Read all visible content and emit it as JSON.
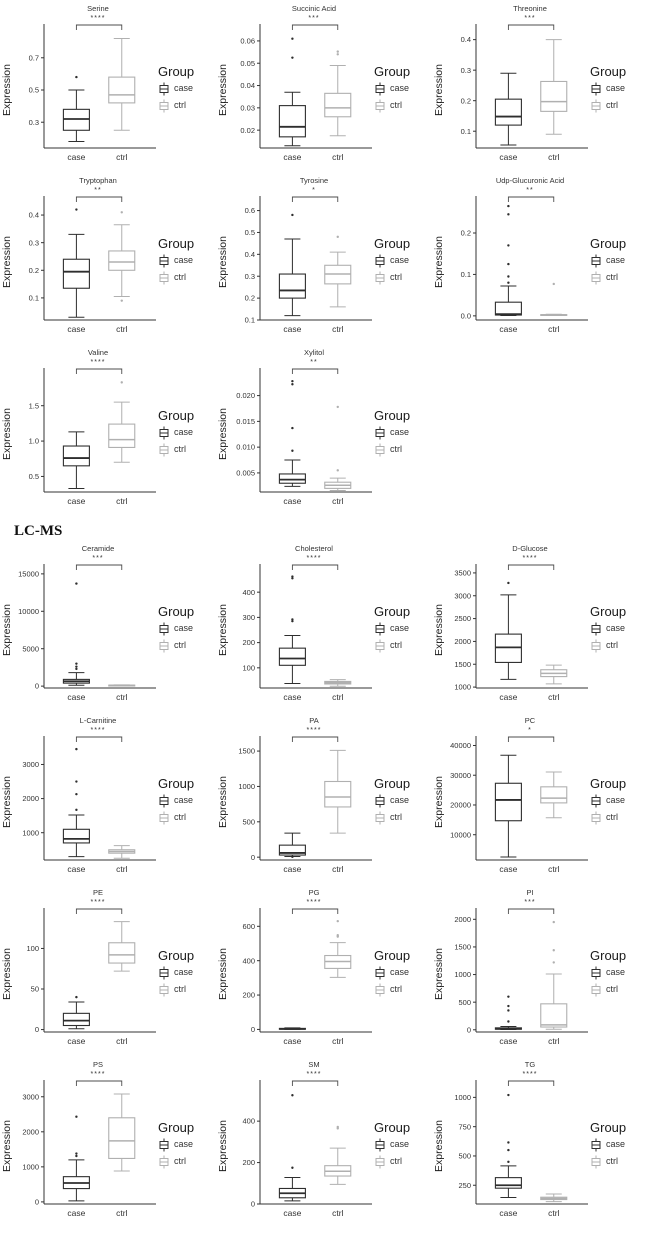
{
  "legend": {
    "title": "Group",
    "entries": [
      "case",
      "ctrl"
    ]
  },
  "colors": {
    "case": "#2e2e2e",
    "ctrl": "#b0b0b0",
    "axis": "#333333"
  },
  "sections": [
    {
      "label": "",
      "panels": [
        0,
        1,
        2,
        3,
        4,
        5,
        6,
        7
      ]
    },
    {
      "label": "LC-MS",
      "panels": [
        8,
        9,
        10,
        11,
        12,
        13,
        14,
        15,
        16,
        17,
        18,
        19
      ]
    }
  ],
  "chart_data": [
    {
      "type": "boxplot",
      "title": "Serine",
      "significance": "****",
      "ylabel": "Expression",
      "categories": [
        "case",
        "ctrl"
      ],
      "yticks": [
        "0.3",
        "0.5",
        "0.7"
      ],
      "ylim": [
        0.14,
        0.86
      ],
      "series": [
        {
          "name": "case",
          "whisker_low": 0.18,
          "q1": 0.25,
          "median": 0.32,
          "q3": 0.38,
          "whisker_high": 0.5,
          "outliers": [
            0.58
          ]
        },
        {
          "name": "ctrl",
          "whisker_low": 0.25,
          "q1": 0.42,
          "median": 0.47,
          "q3": 0.58,
          "whisker_high": 0.82,
          "outliers": []
        }
      ]
    },
    {
      "type": "boxplot",
      "title": "Succinic Acid",
      "significance": "***",
      "ylabel": "Expression",
      "categories": [
        "case",
        "ctrl"
      ],
      "yticks": [
        "0.02",
        "0.03",
        "0.04",
        "0.05",
        "0.06"
      ],
      "ylim": [
        0.012,
        0.064
      ],
      "series": [
        {
          "name": "case",
          "whisker_low": 0.013,
          "q1": 0.017,
          "median": 0.0215,
          "q3": 0.031,
          "whisker_high": 0.037,
          "outliers": [
            0.0525,
            0.061
          ]
        },
        {
          "name": "ctrl",
          "whisker_low": 0.0175,
          "q1": 0.026,
          "median": 0.03,
          "q3": 0.0365,
          "whisker_high": 0.049,
          "outliers": [
            0.054,
            0.0552
          ]
        }
      ]
    },
    {
      "type": "boxplot",
      "title": "Threonine",
      "significance": "***",
      "ylabel": "Expression",
      "categories": [
        "case",
        "ctrl"
      ],
      "yticks": [
        "0.1",
        "0.2",
        "0.3",
        "0.4"
      ],
      "ylim": [
        0.045,
        0.425
      ],
      "series": [
        {
          "name": "case",
          "whisker_low": 0.055,
          "q1": 0.12,
          "median": 0.148,
          "q3": 0.205,
          "whisker_high": 0.29,
          "outliers": []
        },
        {
          "name": "ctrl",
          "whisker_low": 0.09,
          "q1": 0.165,
          "median": 0.197,
          "q3": 0.263,
          "whisker_high": 0.4,
          "outliers": []
        }
      ]
    },
    {
      "type": "boxplot",
      "title": "Tryptophan",
      "significance": "**",
      "ylabel": "Expression",
      "categories": [
        "case",
        "ctrl"
      ],
      "yticks": [
        "0.1",
        "0.2",
        "0.3",
        "0.4"
      ],
      "ylim": [
        0.02,
        0.44
      ],
      "series": [
        {
          "name": "case",
          "whisker_low": 0.03,
          "q1": 0.135,
          "median": 0.195,
          "q3": 0.24,
          "whisker_high": 0.33,
          "outliers": [
            0.42
          ]
        },
        {
          "name": "ctrl",
          "whisker_low": 0.105,
          "q1": 0.2,
          "median": 0.23,
          "q3": 0.27,
          "whisker_high": 0.365,
          "outliers": [
            0.09,
            0.41
          ]
        }
      ]
    },
    {
      "type": "boxplot",
      "title": "Tyrosine",
      "significance": "*",
      "ylabel": "Expression",
      "categories": [
        "case",
        "ctrl"
      ],
      "yticks": [
        "0.1",
        "0.2",
        "0.3",
        "0.4",
        "0.5",
        "0.6"
      ],
      "ylim": [
        0.1,
        0.63
      ],
      "series": [
        {
          "name": "case",
          "whisker_low": 0.12,
          "q1": 0.2,
          "median": 0.235,
          "q3": 0.31,
          "whisker_high": 0.47,
          "outliers": [
            0.58
          ]
        },
        {
          "name": "ctrl",
          "whisker_low": 0.16,
          "q1": 0.265,
          "median": 0.31,
          "q3": 0.35,
          "whisker_high": 0.41,
          "outliers": [
            0.48
          ]
        }
      ]
    },
    {
      "type": "boxplot",
      "title": "Udp-Glucuronic Acid",
      "significance": "**",
      "ylabel": "Expression",
      "categories": [
        "case",
        "ctrl"
      ],
      "yticks": [
        "0.0",
        "0.1",
        "0.2"
      ],
      "ylim": [
        -0.01,
        0.27
      ],
      "series": [
        {
          "name": "case",
          "whisker_low": 0.001,
          "q1": 0.002,
          "median": 0.004,
          "q3": 0.033,
          "whisker_high": 0.072,
          "outliers": [
            0.08,
            0.095,
            0.125,
            0.17,
            0.245,
            0.265
          ]
        },
        {
          "name": "ctrl",
          "whisker_low": 0.001,
          "q1": 0.0015,
          "median": 0.002,
          "q3": 0.003,
          "whisker_high": 0.004,
          "outliers": [
            0.077
          ]
        }
      ]
    },
    {
      "type": "boxplot",
      "title": "Valine",
      "significance": "****",
      "ylabel": "Expression",
      "categories": [
        "case",
        "ctrl"
      ],
      "yticks": [
        "0.5",
        "1.0",
        "1.5"
      ],
      "ylim": [
        0.28,
        1.92
      ],
      "series": [
        {
          "name": "case",
          "whisker_low": 0.33,
          "q1": 0.65,
          "median": 0.76,
          "q3": 0.93,
          "whisker_high": 1.13,
          "outliers": []
        },
        {
          "name": "ctrl",
          "whisker_low": 0.7,
          "q1": 0.91,
          "median": 1.02,
          "q3": 1.24,
          "whisker_high": 1.55,
          "outliers": [
            1.83
          ]
        }
      ]
    },
    {
      "type": "boxplot",
      "title": "Xylitol",
      "significance": "**",
      "ylabel": "Expression",
      "categories": [
        "case",
        "ctrl"
      ],
      "yticks": [
        "0.005",
        "0.010",
        "0.015",
        "0.020"
      ],
      "ylim": [
        0.0013,
        0.0238
      ],
      "series": [
        {
          "name": "case",
          "whisker_low": 0.0024,
          "q1": 0.003,
          "median": 0.0037,
          "q3": 0.0048,
          "whisker_high": 0.0075,
          "outliers": [
            0.0093,
            0.0137,
            0.0222,
            0.0228
          ]
        },
        {
          "name": "ctrl",
          "whisker_low": 0.0016,
          "q1": 0.002,
          "median": 0.0026,
          "q3": 0.0032,
          "whisker_high": 0.004,
          "outliers": [
            0.0055,
            0.0178
          ]
        }
      ]
    },
    {
      "type": "boxplot",
      "title": "Ceramide",
      "significance": "***",
      "ylabel": "Expression",
      "categories": [
        "case",
        "ctrl"
      ],
      "yticks": [
        "0",
        "5000",
        "10000",
        "15000"
      ],
      "ylim": [
        -250,
        15250
      ],
      "series": [
        {
          "name": "case",
          "whisker_low": 120,
          "q1": 400,
          "median": 650,
          "q3": 900,
          "whisker_high": 1800,
          "outliers": [
            2300,
            2600,
            3000,
            13700
          ]
        },
        {
          "name": "ctrl",
          "whisker_low": 60,
          "q1": 90,
          "median": 110,
          "q3": 130,
          "whisker_high": 160,
          "outliers": []
        }
      ]
    },
    {
      "type": "boxplot",
      "title": "Cholesterol",
      "significance": "****",
      "ylabel": "Expression",
      "categories": [
        "case",
        "ctrl"
      ],
      "yticks": [
        "100",
        "200",
        "300",
        "400"
      ],
      "ylim": [
        20,
        480
      ],
      "series": [
        {
          "name": "case",
          "whisker_low": 38,
          "q1": 110,
          "median": 137,
          "q3": 178,
          "whisker_high": 228,
          "outliers": [
            285,
            292,
            455,
            462
          ]
        },
        {
          "name": "ctrl",
          "whisker_low": 27,
          "q1": 36,
          "median": 41,
          "q3": 46,
          "whisker_high": 53,
          "outliers": []
        }
      ]
    },
    {
      "type": "boxplot",
      "title": "D-Glucose",
      "significance": "****",
      "ylabel": "Expression",
      "categories": [
        "case",
        "ctrl"
      ],
      "yticks": [
        "1000",
        "1500",
        "2000",
        "2500",
        "3000",
        "3500"
      ],
      "ylim": [
        980,
        3520
      ],
      "series": [
        {
          "name": "case",
          "whisker_low": 1170,
          "q1": 1540,
          "median": 1870,
          "q3": 2160,
          "whisker_high": 3020,
          "outliers": [
            3280
          ]
        },
        {
          "name": "ctrl",
          "whisker_low": 1070,
          "q1": 1230,
          "median": 1300,
          "q3": 1380,
          "whisker_high": 1480,
          "outliers": []
        }
      ]
    },
    {
      "type": "boxplot",
      "title": "L-Carnitine",
      "significance": "****",
      "ylabel": "Expression",
      "categories": [
        "case",
        "ctrl"
      ],
      "yticks": [
        "1000",
        "2000",
        "3000"
      ],
      "ylim": [
        200,
        3600
      ],
      "series": [
        {
          "name": "case",
          "whisker_low": 300,
          "q1": 700,
          "median": 820,
          "q3": 1100,
          "whisker_high": 1520,
          "outliers": [
            1670,
            2130,
            2500,
            3450
          ]
        },
        {
          "name": "ctrl",
          "whisker_low": 250,
          "q1": 400,
          "median": 450,
          "q3": 500,
          "whisker_high": 620,
          "outliers": []
        }
      ]
    },
    {
      "type": "boxplot",
      "title": "PA",
      "significance": "****",
      "ylabel": "Expression",
      "categories": [
        "case",
        "ctrl"
      ],
      "yticks": [
        "0",
        "500",
        "1000",
        "1500"
      ],
      "ylim": [
        -40,
        1600
      ],
      "series": [
        {
          "name": "case",
          "whisker_low": 10,
          "q1": 30,
          "median": 60,
          "q3": 170,
          "whisker_high": 340,
          "outliers": [
            5
          ]
        },
        {
          "name": "ctrl",
          "whisker_low": 340,
          "q1": 710,
          "median": 850,
          "q3": 1070,
          "whisker_high": 1510,
          "outliers": []
        }
      ]
    },
    {
      "type": "boxplot",
      "title": "PC",
      "significance": "*",
      "ylabel": "Expression",
      "categories": [
        "case",
        "ctrl"
      ],
      "yticks": [
        "10000",
        "20000",
        "30000",
        "40000"
      ],
      "ylim": [
        1500,
        40500
      ],
      "series": [
        {
          "name": "case",
          "whisker_low": 2500,
          "q1": 14700,
          "median": 21700,
          "q3": 27300,
          "whisker_high": 36700,
          "outliers": []
        },
        {
          "name": "ctrl",
          "whisker_low": 15700,
          "q1": 20700,
          "median": 22300,
          "q3": 26100,
          "whisker_high": 31100,
          "outliers": []
        }
      ]
    },
    {
      "type": "boxplot",
      "title": "PE",
      "significance": "****",
      "ylabel": "Expression",
      "categories": [
        "case",
        "ctrl"
      ],
      "yticks": [
        "0",
        "50",
        "100"
      ],
      "ylim": [
        -3,
        140
      ],
      "series": [
        {
          "name": "case",
          "whisker_low": 1,
          "q1": 5,
          "median": 11,
          "q3": 20,
          "whisker_high": 34,
          "outliers": [
            40
          ]
        },
        {
          "name": "ctrl",
          "whisker_low": 72,
          "q1": 82,
          "median": 92,
          "q3": 107,
          "whisker_high": 133,
          "outliers": []
        }
      ]
    },
    {
      "type": "boxplot",
      "title": "PG",
      "significance": "****",
      "ylabel": "Expression",
      "categories": [
        "case",
        "ctrl"
      ],
      "yticks": [
        "0",
        "200",
        "400",
        "600"
      ],
      "ylim": [
        -15,
        660
      ],
      "series": [
        {
          "name": "case",
          "whisker_low": 0,
          "q1": 1,
          "median": 3,
          "q3": 6,
          "whisker_high": 9,
          "outliers": []
        },
        {
          "name": "ctrl",
          "whisker_low": 303,
          "q1": 355,
          "median": 395,
          "q3": 430,
          "whisker_high": 505,
          "outliers": [
            540,
            548,
            630
          ]
        }
      ]
    },
    {
      "type": "boxplot",
      "title": "PI",
      "significance": "***",
      "ylabel": "Expression",
      "categories": [
        "case",
        "ctrl"
      ],
      "yticks": [
        "0",
        "500",
        "1000",
        "1500",
        "2000"
      ],
      "ylim": [
        -40,
        2060
      ],
      "series": [
        {
          "name": "case",
          "whisker_low": 5,
          "q1": 10,
          "median": 20,
          "q3": 35,
          "whisker_high": 60,
          "outliers": [
            150,
            350,
            430,
            600
          ]
        },
        {
          "name": "ctrl",
          "whisker_low": 10,
          "q1": 50,
          "median": 90,
          "q3": 470,
          "whisker_high": 1010,
          "outliers": [
            1220,
            1440,
            1950
          ]
        }
      ]
    },
    {
      "type": "boxplot",
      "title": "PS",
      "significance": "****",
      "ylabel": "Expression",
      "categories": [
        "case",
        "ctrl"
      ],
      "yticks": [
        "0",
        "1000",
        "2000",
        "3000"
      ],
      "ylim": [
        -60,
        3250
      ],
      "series": [
        {
          "name": "case",
          "whisker_low": 30,
          "q1": 380,
          "median": 540,
          "q3": 720,
          "whisker_high": 1200,
          "outliers": [
            1310,
            1380,
            2430
          ]
        },
        {
          "name": "ctrl",
          "whisker_low": 880,
          "q1": 1240,
          "median": 1740,
          "q3": 2400,
          "whisker_high": 3080,
          "outliers": []
        }
      ]
    },
    {
      "type": "boxplot",
      "title": "SM",
      "significance": "****",
      "ylabel": "Expression",
      "categories": [
        "case",
        "ctrl"
      ],
      "yticks": [
        "0",
        "200",
        "400"
      ],
      "ylim": [
        0,
        560
      ],
      "series": [
        {
          "name": "case",
          "whisker_low": 15,
          "q1": 30,
          "median": 52,
          "q3": 75,
          "whisker_high": 128,
          "outliers": [
            175,
            525
          ]
        },
        {
          "name": "ctrl",
          "whisker_low": 95,
          "q1": 135,
          "median": 158,
          "q3": 185,
          "whisker_high": 270,
          "outliers": [
            365,
            372
          ]
        }
      ]
    },
    {
      "type": "boxplot",
      "title": "TG",
      "significance": "****",
      "ylabel": "Expression",
      "categories": [
        "case",
        "ctrl"
      ],
      "yticks": [
        "250",
        "500",
        "750",
        "1000"
      ],
      "ylim": [
        90,
        1080
      ],
      "series": [
        {
          "name": "case",
          "whisker_low": 145,
          "q1": 225,
          "median": 250,
          "q3": 315,
          "whisker_high": 415,
          "outliers": [
            450,
            550,
            615,
            1020
          ]
        },
        {
          "name": "ctrl",
          "whisker_low": 110,
          "q1": 128,
          "median": 138,
          "q3": 148,
          "whisker_high": 175,
          "outliers": []
        }
      ]
    }
  ]
}
